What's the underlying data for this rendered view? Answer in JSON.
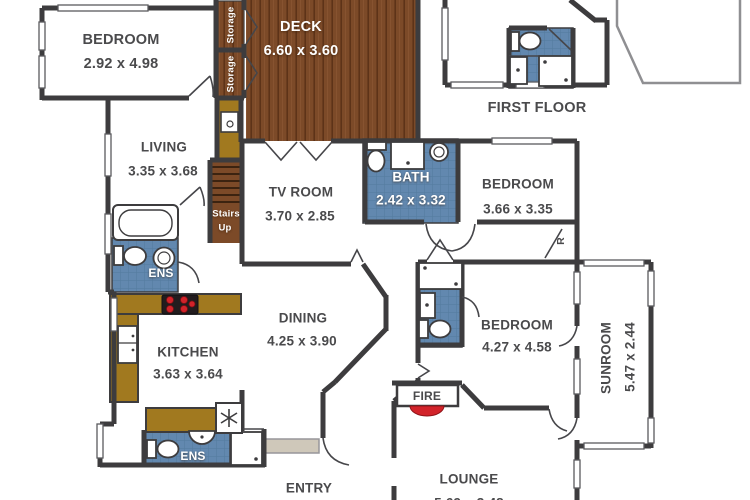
{
  "floor_label": "FIRST FLOOR",
  "rooms": {
    "bedroom1": {
      "name": "BEDROOM",
      "dims": "2.92 x 4.98"
    },
    "deck": {
      "name": "DECK",
      "dims": "6.60 x 3.60"
    },
    "storage_upper": {
      "name": "Storage"
    },
    "storage_lower": {
      "name": "Storage"
    },
    "living": {
      "name": "LIVING",
      "dims": "3.35 x 3.68"
    },
    "tv_room": {
      "name": "TV ROOM",
      "dims": "3.70 x 2.85"
    },
    "bath": {
      "name": "BATH",
      "dims": "2.42 x 3.32"
    },
    "bedroom2": {
      "name": "BEDROOM",
      "dims": "3.66 x 3.35"
    },
    "stairs": {
      "line1": "Stairs",
      "line2": "Up"
    },
    "ensuite1": {
      "name": "ENS"
    },
    "dining": {
      "name": "DINING",
      "dims": "4.25 x 3.90"
    },
    "kitchen": {
      "name": "KITCHEN",
      "dims": "3.63 x 3.64"
    },
    "bedroom3": {
      "name": "BEDROOM",
      "dims": "4.27 x 4.58"
    },
    "sunroom": {
      "name": "SUNROOM",
      "dims": "5.47 x 2.44"
    },
    "robe": {
      "name": "R"
    },
    "fireplace": {
      "name": "FIRE"
    },
    "ensuite2": {
      "name": "ENS"
    },
    "entry": {
      "name": "ENTRY"
    },
    "lounge": {
      "name": "LOUNGE",
      "dims": "5.69 x 3.48"
    }
  },
  "colors": {
    "wall": "#3d3c3e",
    "deck_wood": "#7c4a28",
    "deck_grain": "#5d3318",
    "bench_wood": "#a1791f",
    "tile_blue": "#6288af",
    "tile_grid": "#537a9e",
    "fire_red": "#d2232a",
    "porch": "#cfc8ba",
    "label_text": "#4a4a4c",
    "white_text": "#ffffff"
  }
}
